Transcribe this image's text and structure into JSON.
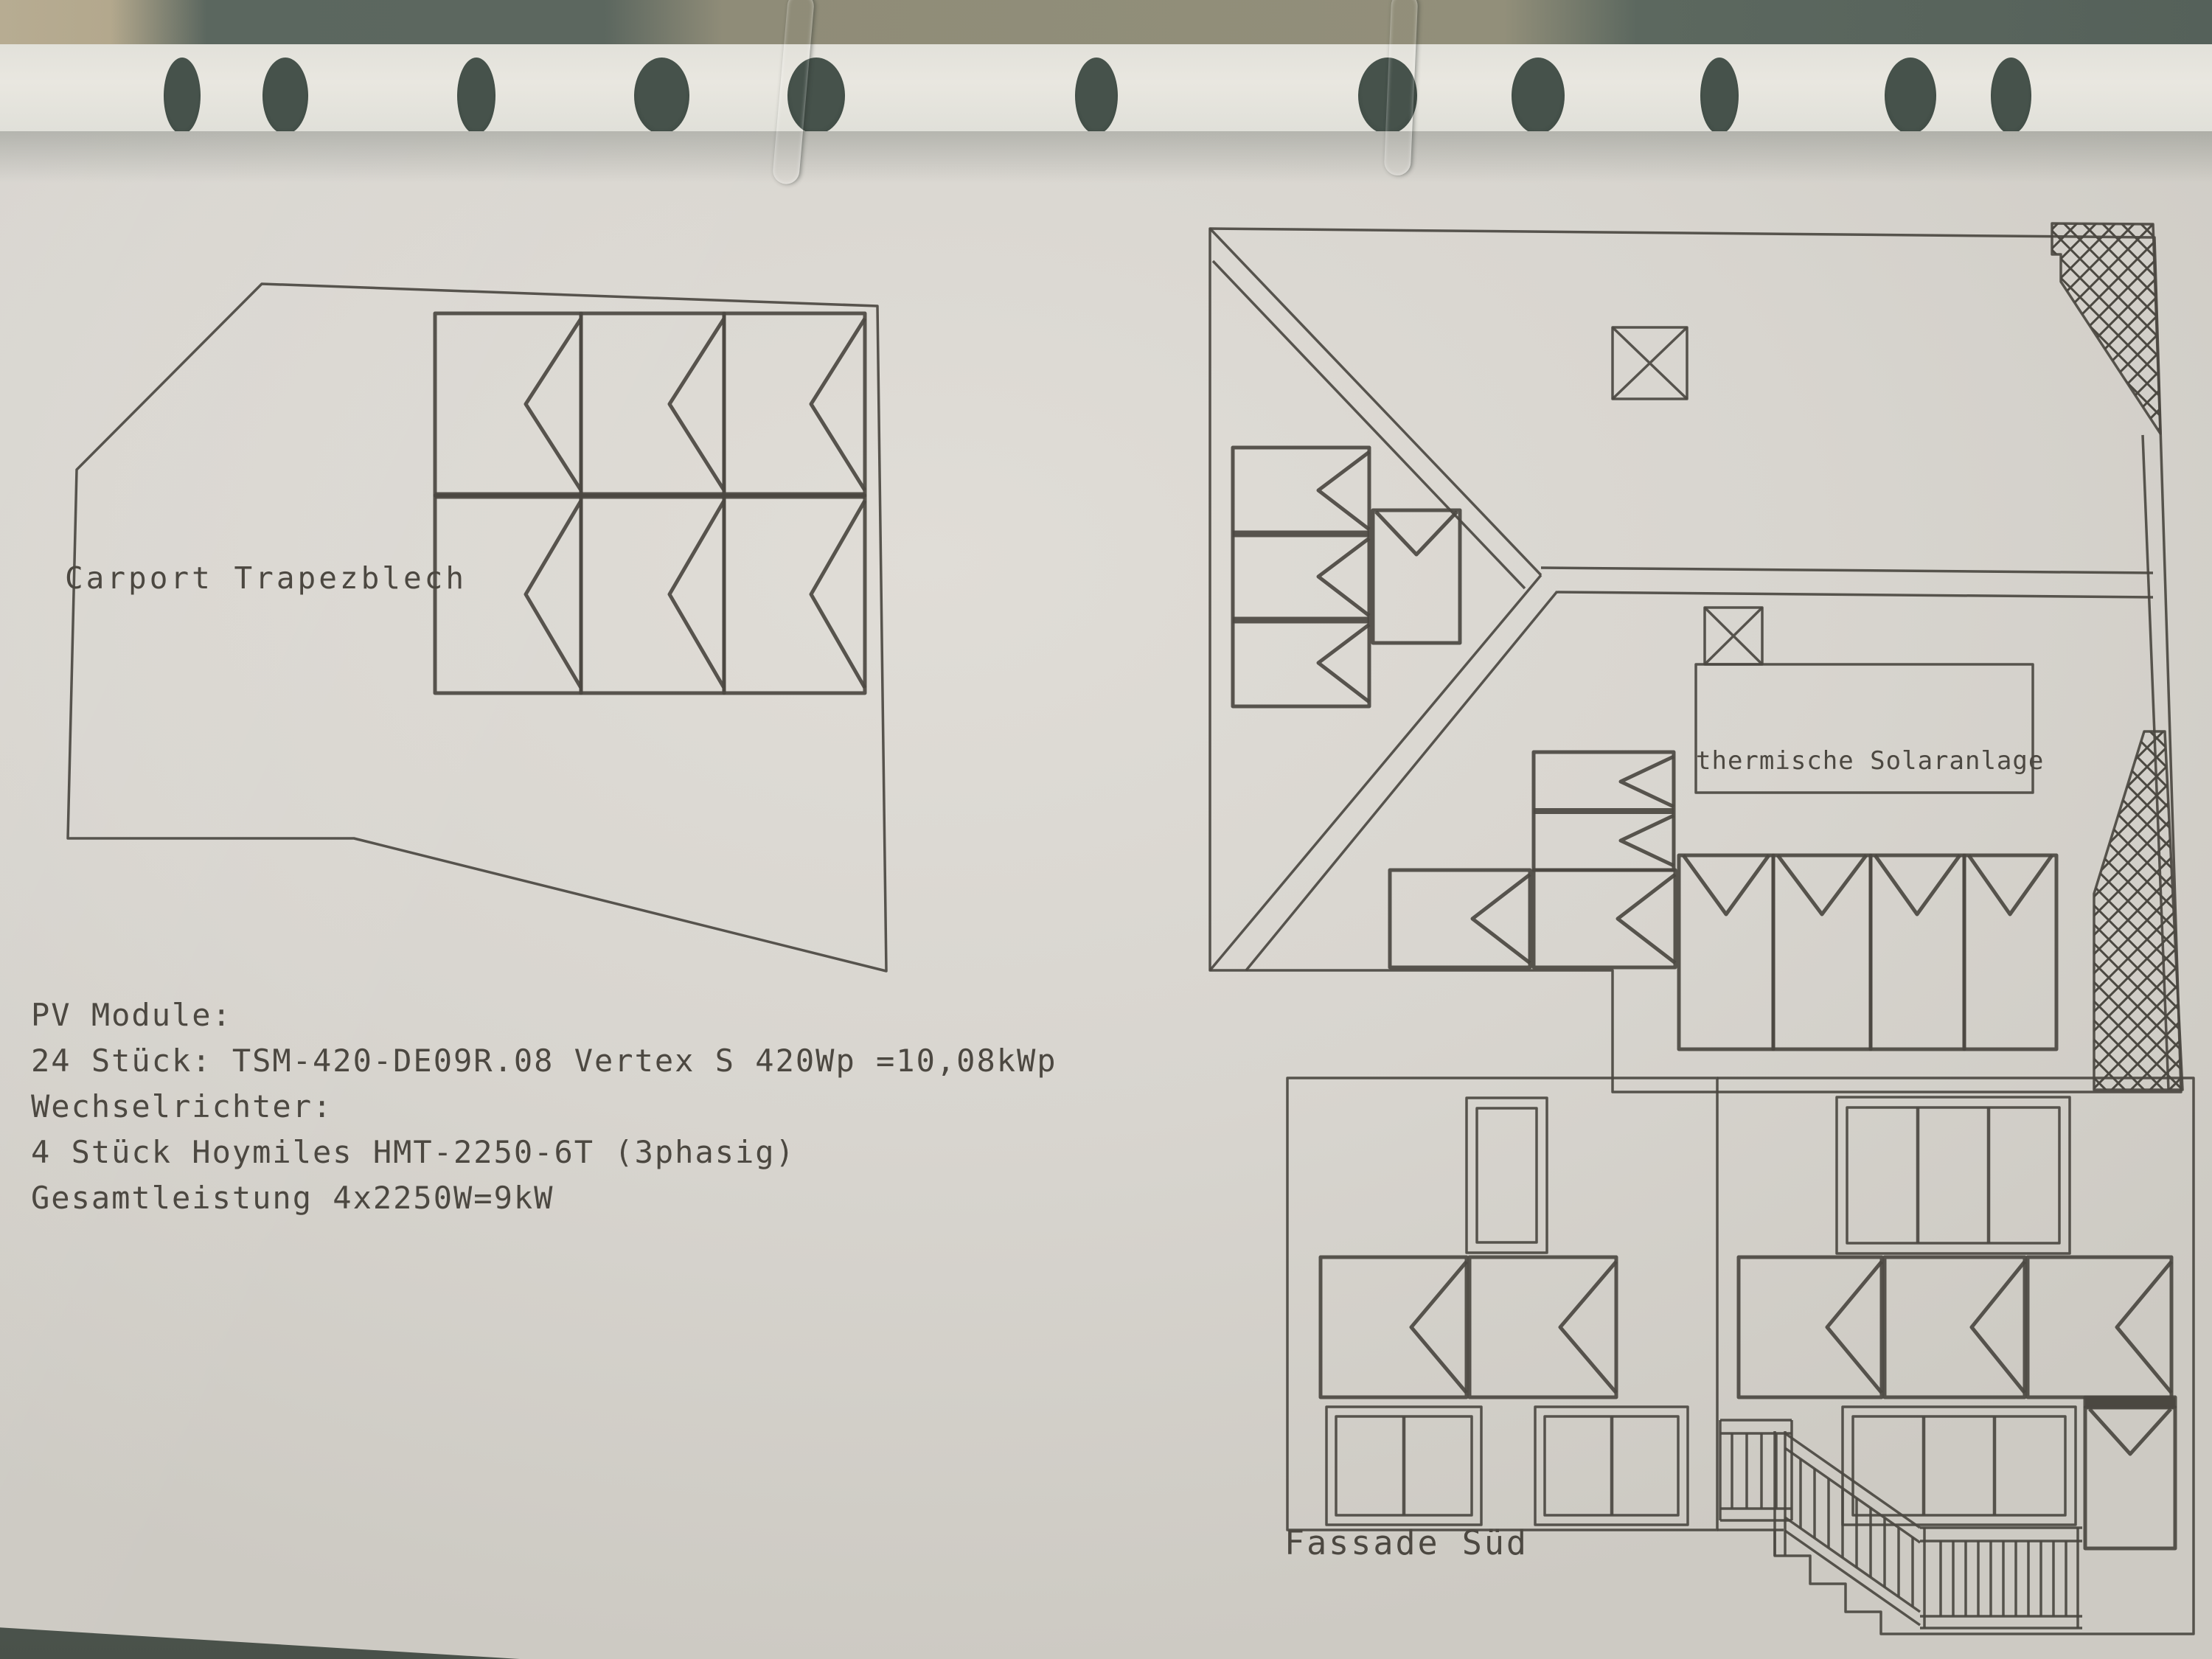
{
  "binder": {
    "hole_count": 11,
    "ring_count": 2
  },
  "drawing": {
    "carport": {
      "label": "Carport Trapezblech",
      "module_count": 6
    },
    "roof_plan": {
      "thermal_label": "thermische Solaranlage",
      "module_count": 12,
      "skylight_count": 2
    },
    "facade": {
      "label": "Fassade Süd",
      "module_count": 6
    }
  },
  "spec": {
    "pv_header": "PV Module:",
    "pv_detail": "24 Stück: TSM-420-DE09R.08 Vertex S 420Wp =10,08kWp",
    "inverter_header": "Wechselrichter:",
    "inverter_detail": "4 Stück Hoymiles HMT-2250-6T (3phasig)",
    "total": "Gesamtleistung 4x2250W=9kW"
  },
  "colors": {
    "ink": "#4b4841",
    "paper": "#d8d5cf",
    "binder_dark": "#5b675f"
  }
}
